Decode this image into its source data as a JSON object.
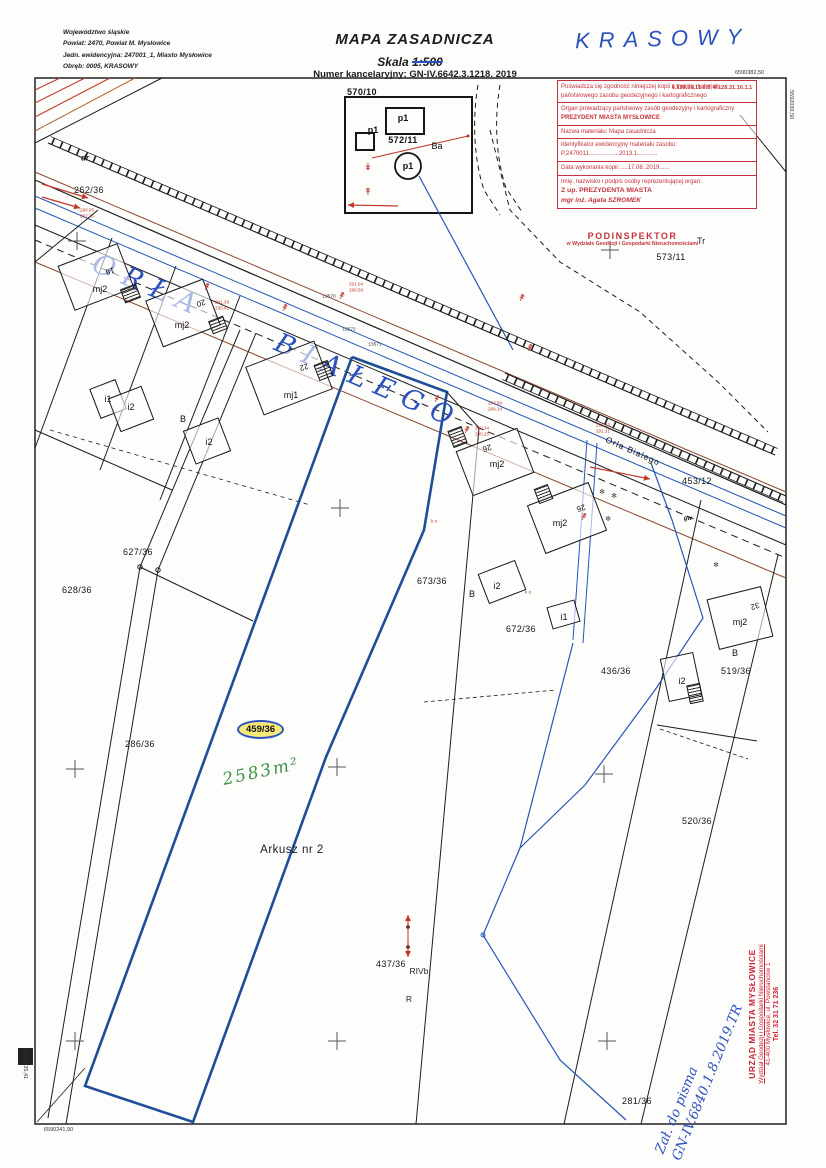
{
  "header": {
    "line1": "Województwo śląskie",
    "line2": "Powiat: 2470, Powiat M. Mysłowice",
    "line3": "Jedn. ewidencyjna: 247001_1, Miasto Mysłowice",
    "line4": "Obręb: 0005, KRASOWY",
    "title": "MAPA ZASADNICZA",
    "scale_label": "Skala",
    "scale_value": "1:500",
    "registry_number": "Numer kancelaryjny: GN-IV.6642.3.1218. 2019",
    "region_handwritten": "KRASOWY"
  },
  "stamp": {
    "row1": "Poświadcza się zgodność niniejszej kopii z treścią materiału państwowego zasobu geodezyjnego i kartograficznego",
    "row2a": "Organ prowadzący państwowy zasób geodezyjny i kartograficzny",
    "row2b": "PREZYDENT MIASTA MYSŁOWICE",
    "row3": "Nazwa materiału: Mapa zasadnicza",
    "row4a": "Identyfikator ewidencyjny materiału zasobu:",
    "row4b": "P.2470011..................2013.1............",
    "row5": "Data wykonania kopii: ....17.08..2019......",
    "row6a": "Imię, nazwisko i podpis osoby reprezentującej organ:",
    "row6b": "Z up. PREZYDENTA MIASTA",
    "row6c": "mgr inż. Agata SZROMEK",
    "doc_id": "6.128.31.11.3.3, 6.128.31.16.1.1"
  },
  "inspector": {
    "title": "PODINSPEKTOR",
    "subtitle": "w Wydziale Geodezji i Gospodarki Nieruchomościami",
    "initials": "Tr"
  },
  "street": {
    "handwritten": "ORŁA BIAŁEGO",
    "printed": "Orla Bialego"
  },
  "highlight": {
    "parcel": "459/36",
    "area_note": "2583m²"
  },
  "corner_coords": {
    "top_right_h": "6590382,50",
    "right_v": "5592030,50",
    "left_v": "5591935,41",
    "bottom_left_h": "6590241,90"
  },
  "office_stamp": {
    "line1": "URZĄD MIASTA MYSŁOWICE",
    "line2": "Wydział Geodezji i Gospodarki Nieruchomościami",
    "line3": "41-400 Mysłowice, ul. Powstańców 1",
    "line4": "Tel. 32 31 71 236"
  },
  "attachment_note": {
    "line1": "Zał. do pisma",
    "line2": "GN-IV.6840.1.8.2019.TR"
  },
  "colors": {
    "hand_blue": "#2b50c0",
    "stamp_red": "#c4333c",
    "area_green": "#3f9142",
    "highlight_yellow": "#f6e97a",
    "parcel_outline_blue": "#1d4e96"
  },
  "map_labels": [
    {
      "name": "parcel-570-10",
      "text": "570/10",
      "x": 362,
      "y": 92,
      "cls": "parcel bold"
    },
    {
      "name": "parcel-572-11",
      "text": "572/11",
      "x": 403,
      "y": 140,
      "cls": "parcel bold"
    },
    {
      "name": "parcel-573-11",
      "text": "573/11",
      "x": 671,
      "y": 257,
      "cls": "parcel"
    },
    {
      "name": "parcel-262-36",
      "text": "262/36",
      "x": 89,
      "y": 190,
      "cls": "parcel"
    },
    {
      "name": "parcel-627-36",
      "text": "627/36",
      "x": 138,
      "y": 552,
      "cls": "parcel"
    },
    {
      "name": "parcel-628-36",
      "text": "628/36",
      "x": 77,
      "y": 590,
      "cls": "parcel"
    },
    {
      "name": "parcel-286-36",
      "text": "286/36",
      "x": 140,
      "y": 744,
      "cls": "parcel"
    },
    {
      "name": "parcel-673-36",
      "text": "673/36",
      "x": 432,
      "y": 581,
      "cls": "parcel"
    },
    {
      "name": "parcel-672-36",
      "text": "672/36",
      "x": 521,
      "y": 629,
      "cls": "parcel"
    },
    {
      "name": "parcel-436-36",
      "text": "436/36",
      "x": 616,
      "y": 671,
      "cls": "parcel"
    },
    {
      "name": "parcel-519-36",
      "text": "519/36",
      "x": 736,
      "y": 671,
      "cls": "parcel"
    },
    {
      "name": "parcel-520-36",
      "text": "520/36",
      "x": 697,
      "y": 821,
      "cls": "parcel"
    },
    {
      "name": "parcel-453-12",
      "text": "453/12",
      "x": 697,
      "y": 481,
      "cls": "parcel"
    },
    {
      "name": "parcel-437-36",
      "text": "437/36",
      "x": 391,
      "y": 964,
      "cls": "parcel"
    },
    {
      "name": "parcel-281-36",
      "text": "281/36",
      "x": 637,
      "y": 1101,
      "cls": "parcel"
    },
    {
      "name": "sheet-label",
      "text": "Arkusz nr 2",
      "x": 292,
      "y": 850,
      "cls": "sheet"
    },
    {
      "name": "building-label-mj2",
      "text": "mj2",
      "x": 100,
      "y": 289,
      "cls": "building"
    },
    {
      "name": "building-label-mj2",
      "text": "mj2",
      "x": 182,
      "y": 325,
      "cls": "building"
    },
    {
      "name": "building-label-mj1",
      "text": "mj1",
      "x": 291,
      "y": 395,
      "cls": "building"
    },
    {
      "name": "building-label-mj2",
      "text": "mj2",
      "x": 497,
      "y": 464,
      "cls": "building"
    },
    {
      "name": "building-label-mj2",
      "text": "mj2",
      "x": 560,
      "y": 523,
      "cls": "building"
    },
    {
      "name": "building-label-mj2",
      "text": "mj2",
      "x": 740,
      "y": 622,
      "cls": "building"
    },
    {
      "name": "building-label-i1",
      "text": "i1",
      "x": 108,
      "y": 399,
      "cls": "building"
    },
    {
      "name": "building-label-i1",
      "text": "i1",
      "x": 564,
      "y": 617,
      "cls": "building"
    },
    {
      "name": "building-label-i2",
      "text": "i2",
      "x": 131,
      "y": 407,
      "cls": "building"
    },
    {
      "name": "building-label-i2",
      "text": "i2",
      "x": 209,
      "y": 442,
      "cls": "building"
    },
    {
      "name": "building-label-i2",
      "text": "i2",
      "x": 497,
      "y": 586,
      "cls": "building"
    },
    {
      "name": "building-label-i2",
      "text": "i2",
      "x": 682,
      "y": 681,
      "cls": "building"
    },
    {
      "name": "landuse-label-B",
      "text": "B",
      "x": 183,
      "y": 419,
      "cls": "building"
    },
    {
      "name": "landuse-label-B",
      "text": "B",
      "x": 472,
      "y": 594,
      "cls": "building"
    },
    {
      "name": "landuse-label-B",
      "text": "B",
      "x": 735,
      "y": 653,
      "cls": "building"
    },
    {
      "name": "landuse-label-Ba",
      "text": "Ba",
      "x": 437,
      "y": 146,
      "cls": "building"
    },
    {
      "name": "point-label-p1",
      "text": "p1",
      "x": 403,
      "y": 118,
      "cls": "building bold"
    },
    {
      "name": "point-label-p1",
      "text": "p1",
      "x": 373,
      "y": 130,
      "cls": "building bold"
    },
    {
      "name": "point-label-p1",
      "text": "p1",
      "x": 408,
      "y": 166,
      "cls": "building bold"
    },
    {
      "name": "road-label-dr",
      "text": "dr",
      "x": 85,
      "y": 158,
      "cls": "small-it"
    },
    {
      "name": "utility-label-gw",
      "text": "gw",
      "x": 688,
      "y": 519,
      "cls": "small-it tiny"
    },
    {
      "name": "soil-label-RIVb",
      "text": "RIVb",
      "x": 419,
      "y": 971,
      "cls": "soil"
    },
    {
      "name": "soil-label-R",
      "text": "R",
      "x": 409,
      "y": 999,
      "cls": "soil"
    },
    {
      "name": "house-number",
      "text": "18",
      "x": 110,
      "y": 271,
      "rot": 163,
      "cls": "housenum"
    },
    {
      "name": "house-number",
      "text": "20",
      "x": 201,
      "y": 303,
      "rot": 163,
      "cls": "housenum"
    },
    {
      "name": "house-number",
      "text": "22",
      "x": 304,
      "y": 367,
      "rot": 163,
      "cls": "housenum"
    },
    {
      "name": "house-number",
      "text": "26",
      "x": 487,
      "y": 448,
      "rot": 163,
      "cls": "housenum"
    },
    {
      "name": "house-number",
      "text": "26",
      "x": 581,
      "y": 508,
      "rot": 163,
      "cls": "housenum"
    },
    {
      "name": "house-number",
      "text": "32",
      "x": 755,
      "y": 606,
      "rot": 163,
      "cls": "housenum"
    },
    {
      "name": "survey-point",
      "text": "13570",
      "x": 329,
      "y": 297,
      "cls": "tinyblack"
    },
    {
      "name": "survey-point",
      "text": "13572",
      "x": 349,
      "y": 330,
      "cls": "tinyblack"
    },
    {
      "name": "survey-point",
      "text": "13571",
      "x": 375,
      "y": 345,
      "cls": "tinyblack"
    },
    {
      "name": "elevation-pair",
      "text": "290.05\n287.35",
      "x": 87,
      "y": 213,
      "cls": "tinyred"
    },
    {
      "name": "elevation-pair",
      "text": "291.39\n290.42",
      "x": 222,
      "y": 305,
      "cls": "tinyred"
    },
    {
      "name": "elevation-pair",
      "text": "291.04\n288.58",
      "x": 356,
      "y": 287,
      "cls": "tinyred"
    },
    {
      "name": "elevation-pair",
      "text": "290.99\n289.14",
      "x": 495,
      "y": 406,
      "cls": "tinyred"
    },
    {
      "name": "elevation-pair",
      "text": "290.34\n290.25",
      "x": 482,
      "y": 431,
      "cls": "tinyred"
    },
    {
      "name": "elevation-pair",
      "text": "291.33\n291.31",
      "x": 603,
      "y": 428,
      "cls": "tinyred"
    },
    {
      "name": "annotation-ko",
      "text": "k o",
      "x": 434,
      "y": 521,
      "cls": "tinyred"
    },
    {
      "name": "annotation-ko",
      "text": "k o",
      "x": 528,
      "y": 592,
      "cls": "tinyred"
    },
    {
      "name": "doc-id-note",
      "text": "6.128.31.11.3.3, 6.128.31.16.1.1",
      "x": 712,
      "y": 88,
      "cls": "redid"
    },
    {
      "name": "tree-symbol",
      "text": "✻",
      "x": 602,
      "y": 492,
      "cls": "tree"
    },
    {
      "name": "tree-symbol",
      "text": "✻",
      "x": 614,
      "y": 496,
      "cls": "tree"
    },
    {
      "name": "tree-symbol",
      "text": "✻",
      "x": 608,
      "y": 519,
      "cls": "tree"
    },
    {
      "name": "tree-symbol",
      "text": "✻",
      "x": 716,
      "y": 565,
      "cls": "tree"
    },
    {
      "name": "utility-arrow",
      "text": "↡",
      "x": 368,
      "y": 168,
      "cls": "arrowred"
    },
    {
      "name": "utility-arrow",
      "text": "↟",
      "x": 368,
      "y": 193,
      "cls": "arrowred"
    },
    {
      "name": "utility-arrow",
      "text": "↟",
      "x": 206,
      "y": 288,
      "rot": 25,
      "cls": "arrowred"
    },
    {
      "name": "utility-arrow",
      "text": "↟",
      "x": 284,
      "y": 309,
      "rot": 25,
      "cls": "arrowred"
    },
    {
      "name": "utility-arrow",
      "text": "↟",
      "x": 341,
      "y": 297,
      "rot": 25,
      "cls": "arrowred"
    },
    {
      "name": "utility-arrow",
      "text": "↟",
      "x": 436,
      "y": 400,
      "rot": 25,
      "cls": "arrowred"
    },
    {
      "name": "utility-arrow",
      "text": "↟",
      "x": 466,
      "y": 431,
      "rot": 25,
      "cls": "arrowred"
    },
    {
      "name": "utility-arrow",
      "text": "↟",
      "x": 521,
      "y": 299,
      "rot": 25,
      "cls": "arrowred"
    },
    {
      "name": "utility-arrow",
      "text": "↟",
      "x": 529,
      "y": 349,
      "rot": 25,
      "cls": "arrowred"
    },
    {
      "name": "utility-arrow",
      "text": "↟",
      "x": 583,
      "y": 518,
      "rot": 25,
      "cls": "arrowred"
    },
    {
      "name": "street-label-printed",
      "text": "Orla Bialego",
      "x": 633,
      "y": 451,
      "rot": 24,
      "cls": "printstreet"
    }
  ]
}
